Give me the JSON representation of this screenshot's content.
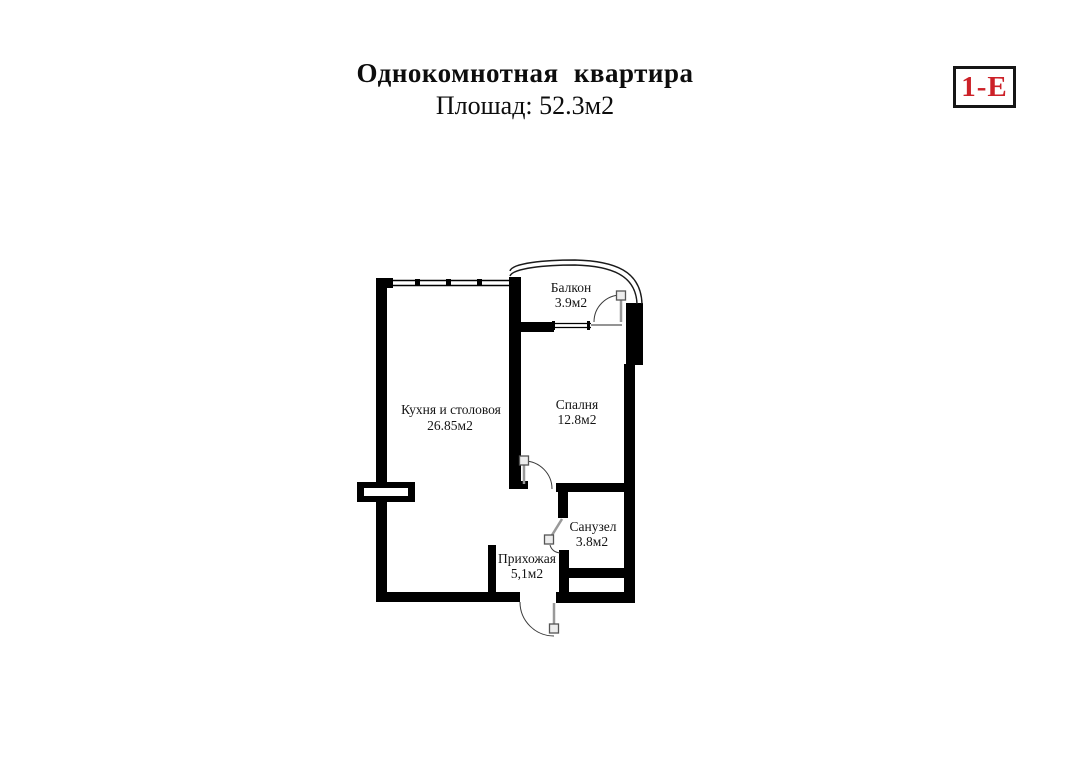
{
  "header": {
    "title": "Однокомнотная квартира",
    "subtitle": "Плошад: 52.3м2"
  },
  "badge": {
    "label": "1-Е",
    "text_color": "#cc2128",
    "border_color": "#161616"
  },
  "plan": {
    "type": "apartment-floorplan",
    "wall_color": "#000000",
    "door_leaf_color": "#999999",
    "rooms": [
      {
        "id": "balcony",
        "name": "Балкон",
        "area": "3.9м2"
      },
      {
        "id": "kitchen",
        "name": "Кухня и столовоя",
        "area": "26.85м2"
      },
      {
        "id": "bedroom",
        "name": "Спалня",
        "area": "12.8м2"
      },
      {
        "id": "bathroom",
        "name": "Санузел",
        "area": "3.8м2"
      },
      {
        "id": "hallway",
        "name": "Прихожая",
        "area": "5,1м2"
      }
    ]
  }
}
